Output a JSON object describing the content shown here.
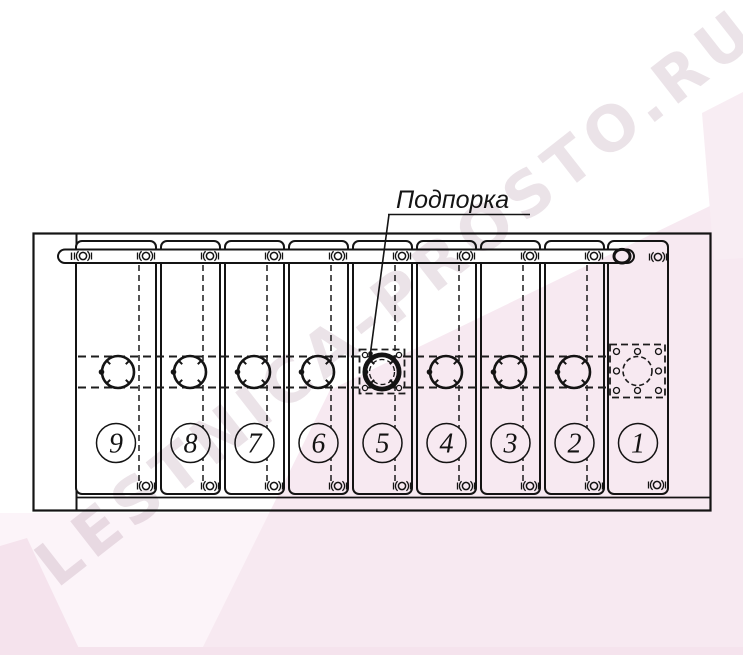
{
  "drawing": {
    "callout_label": "Подпорка",
    "panel_numbers": [
      "9",
      "8",
      "7",
      "6",
      "5",
      "4",
      "3",
      "2",
      "1"
    ]
  },
  "watermark": {
    "text": "LESTNICA-PROSTO.RU"
  },
  "colors": {
    "line": "#141414",
    "watermark_text": "#c5adbb",
    "pink_faint": "#fcf4f9",
    "pink_ribbon": "#f7e9f1",
    "pink_mid": "#f5e3ed",
    "pink_soft": "#f8edf3"
  }
}
